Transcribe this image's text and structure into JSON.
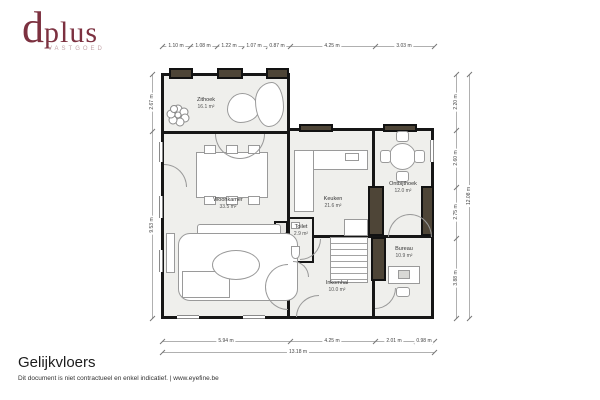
{
  "logo": {
    "text_d": "d",
    "text_rest": "plus",
    "subtext": "VASTGOED",
    "color": "#7c3140"
  },
  "footer": {
    "title": "Gelijkvloers",
    "disclaimer": "Dit document is niet contractueel en enkel indicatief. | www.eyefine.be"
  },
  "rooms": {
    "zithoek": {
      "name": "Zithoek",
      "area": "16.1 m²"
    },
    "woonkamer": {
      "name": "Woonkamer",
      "area": "33.5 m²"
    },
    "keuken": {
      "name": "Keuken",
      "area": "21.6 m²"
    },
    "toilet": {
      "name": "Toilet",
      "area": "2.9 m²"
    },
    "ontbijthoek": {
      "name": "Ontbijthoek",
      "area": "12.0 m²"
    },
    "bureau": {
      "name": "Bureau",
      "area": "10.9 m²"
    },
    "inkomhal": {
      "name": "Inkomhal",
      "area": "10.0 m²"
    }
  },
  "dimensions": {
    "top": [
      "1.10 m",
      "1.08 m",
      "1.22 m",
      "1.07 m",
      "0.87 m",
      "4.25 m",
      "3.03 m"
    ],
    "bottom": [
      "5.94 m",
      "4.25 m",
      "2.01 m",
      "0.98 m"
    ],
    "bottom_total": "13.18 m",
    "right": [
      "2.20 m",
      "2.60 m",
      "2.75 m",
      "3.88 m"
    ],
    "right_total": "12.08 m",
    "left": [
      "2.67 m",
      "9.53 m"
    ]
  },
  "colors": {
    "wall": "#161616",
    "floor": "#efefec",
    "window_mass": "#4e4537",
    "accent": "#7c3140"
  }
}
